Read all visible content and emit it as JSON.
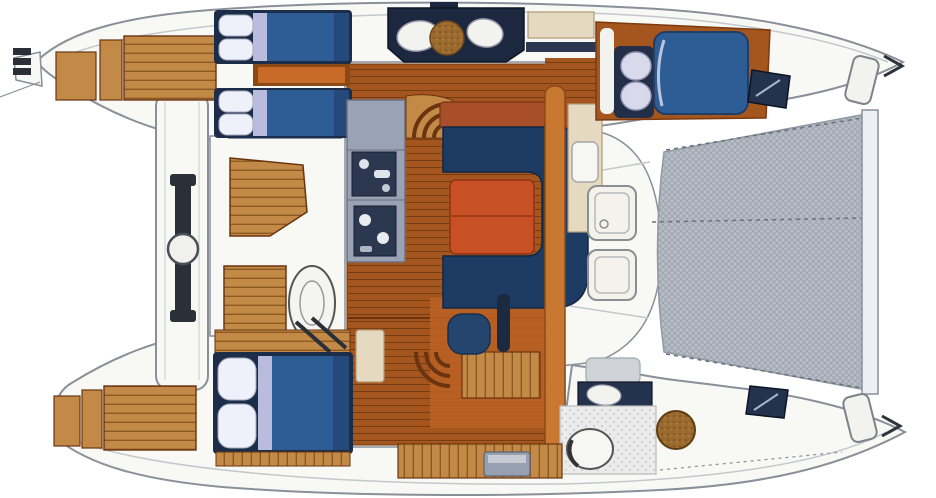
{
  "image_type": "catamaran-yacht-floor-plan-top-view",
  "colors": {
    "hull": "#f8f8f5",
    "outline": "#8a9099",
    "wood": "#a4561e",
    "woodDark": "#6b3410",
    "woodTan": "#c28a46",
    "woodTanDark": "#8a5a22",
    "woodOrange": "#c87830",
    "bedNavy": "#2e5c94",
    "bedFrame": "#1b2d49",
    "pillow": "#eef0fa",
    "lavender": "#b9bcdd",
    "settee": "#1d3b63",
    "cushion": "#24466e",
    "table": "#c94f25",
    "tableDark": "#8d3415",
    "counter": "#9aa2b5",
    "appliance": "#2c3850",
    "console": "#1c2740",
    "tramp": "#b7bdc6",
    "trampLine": "#9aa1ab",
    "window": "#23324d",
    "beige": "#e6d9c2",
    "grayBox": "#97a0b0",
    "whiteFix": "#f2f2ee",
    "shower": "#ebebec",
    "brass": "#9a6a2f"
  },
  "regions": {
    "port_hull": "port hull (top)",
    "starboard_hull": "starboard hull (bottom)",
    "salon": "main salon with wood sole",
    "galley": "galley counter with sink and stove",
    "galley_console": "galley console with twin sinks and round board",
    "dinette": "U-shaped dinette settee",
    "table": "salon table",
    "cockpit": "aft cockpit with teak table and bench",
    "helm_seat": "helm seat",
    "aft_platform": "aft platform with mainsheet traveler",
    "traveler": "mainsheet traveler and winch",
    "stern_steps_port": "port stern swim steps",
    "stern_steps_starboard": "starboard stern swim steps",
    "port_aft_cabin": "port aft cabin with twin berths",
    "starboard_aft_cabin": "starboard aft double cabin",
    "forward_cabin": "port forward double cabin",
    "forward_head": "starboard forward head with shower and toilet",
    "nav_station": "nav cabinet",
    "companionway_port": "curved companionway steps to port hull",
    "companionway_starboard": "companionway steps to starboard hull",
    "foredeck": "foredeck with deck hatches",
    "trampoline": "bow trampoline net",
    "forward_crossbeam": "forward crossbeam",
    "bow_locker_port": "port anchor locker hatch",
    "bow_locker_starboard": "starboard anchor locker hatch",
    "hull_window_port": "port deck window",
    "hull_window_starboard": "starboard deck window",
    "deck_hatch": "deck hatch",
    "round_deck_hatch": "round wooden deck hatch"
  }
}
